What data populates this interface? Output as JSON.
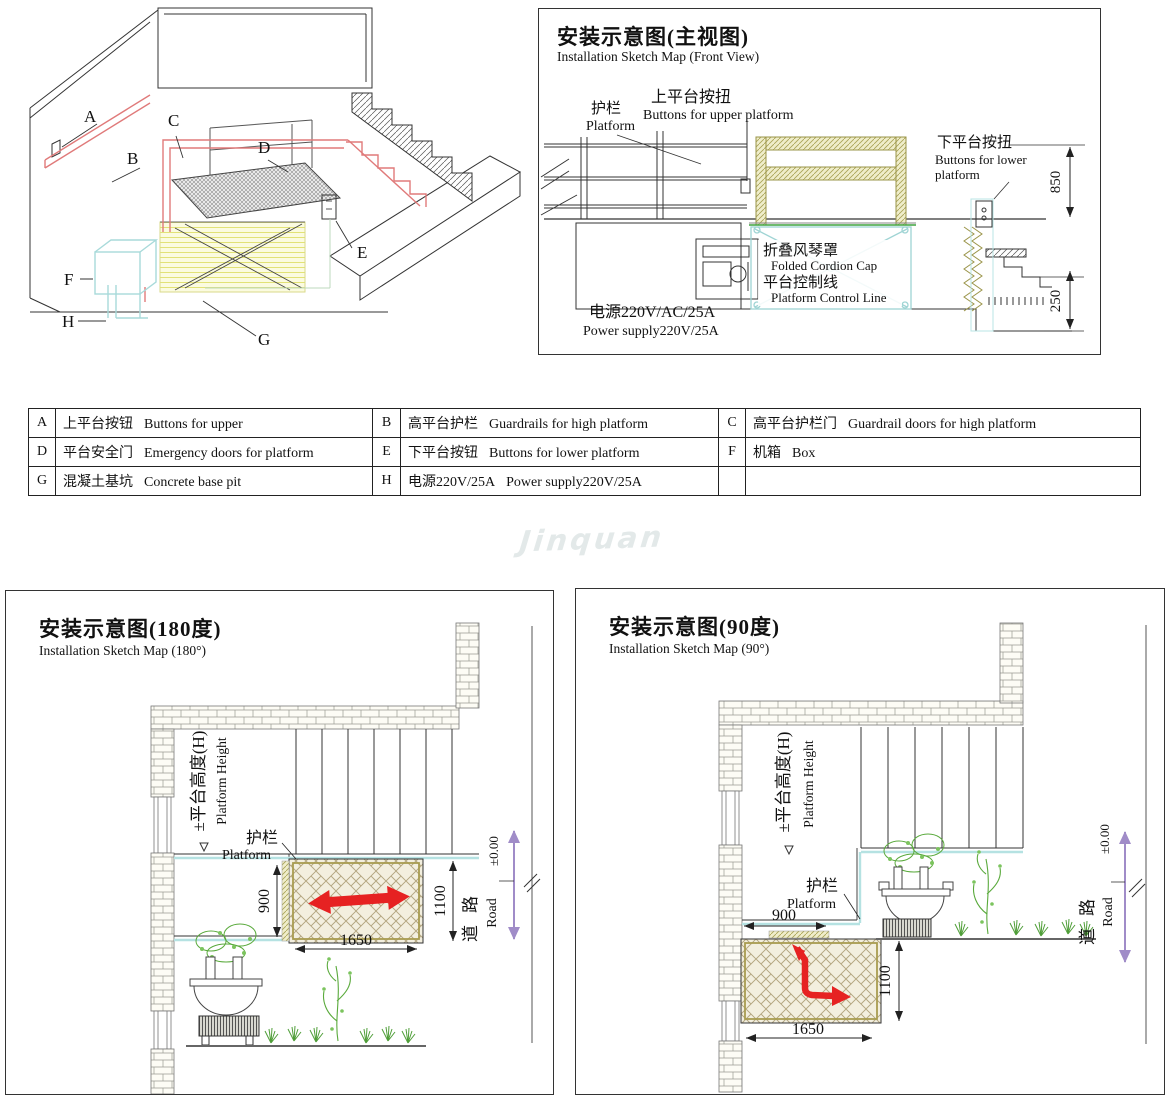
{
  "watermark": {
    "text": "Jinquan"
  },
  "colors": {
    "outline_red": "#e07a7a",
    "arrow_red": "#e62222",
    "scissor_cyan": "#9fd4d4",
    "pit_yellow": "#f6f6c8",
    "road_purple": "#a08cc8",
    "plant_green": "#5aaa3c",
    "watermark_gray": "#e3e9e9"
  },
  "iso": {
    "markers": {
      "A": "A",
      "B": "B",
      "C": "C",
      "D": "D",
      "E": "E",
      "F": "F",
      "G": "G",
      "H": "H"
    }
  },
  "front_view": {
    "title_zh": "安装示意图(主视图)",
    "title_en": "Installation Sketch Map (Front View)",
    "guardrail_zh": "护栏",
    "guardrail_en": "Platform",
    "upper_buttons_zh": "上平台按扭",
    "upper_buttons_en": "Buttons for upper platform",
    "lower_buttons_zh": "下平台按扭",
    "lower_buttons_en_line1": "Buttons for lower",
    "lower_buttons_en_line2": "platform",
    "cordion_zh": "折叠风琴罩",
    "cordion_en": "Folded Cordion Cap",
    "control_zh": "平台控制线",
    "control_en": "Platform Control Line",
    "power_zh": "电源220V/AC/25A",
    "power_en": "Power supply220V/25A",
    "dim_height": "850",
    "dim_pit": "250"
  },
  "legend": {
    "rows": [
      [
        {
          "key": "A",
          "zh": "上平台按钮",
          "en": "Buttons for upper"
        },
        {
          "key": "B",
          "zh": "高平台护栏",
          "en": "Guardrails for high platform"
        },
        {
          "key": "C",
          "zh": "高平台护栏门",
          "en": "Guardrail doors for high platform"
        }
      ],
      [
        {
          "key": "D",
          "zh": "平台安全门",
          "en": "Emergency doors for platform"
        },
        {
          "key": "E",
          "zh": "下平台按钮",
          "en": "Buttons for lower platform"
        },
        {
          "key": "F",
          "zh": "机箱",
          "en": "Box"
        }
      ],
      [
        {
          "key": "G",
          "zh": "混凝土基坑",
          "en": "Concrete base pit"
        },
        {
          "key": "H",
          "zh": "电源220V/25A",
          "en": "Power supply220V/25A"
        },
        {
          "key": "",
          "zh": "",
          "en": ""
        }
      ]
    ]
  },
  "map180": {
    "title_zh": "安装示意图(180度)",
    "title_en": "Installation Sketch Map (180°)",
    "height_zh": "±平台高度(H)",
    "height_en": "Platform Height",
    "guardrail_zh": "护栏",
    "guardrail_en": "Platform",
    "dim_depth": "900",
    "dim_width": "1650",
    "dim_front": "1100",
    "road_zh": "道路",
    "road_en": "Road",
    "level": "±0.00"
  },
  "map90": {
    "title_zh": "安装示意图(90度)",
    "title_en": "Installation Sketch Map (90°)",
    "height_zh": "±平台高度(H)",
    "height_en": "Platform Height",
    "guardrail_zh": "护栏",
    "guardrail_en": "Platform",
    "dim_depth": "900",
    "dim_width": "1650",
    "dim_front": "1100",
    "road_zh": "道路",
    "road_en": "Road",
    "level": "±0.00"
  }
}
